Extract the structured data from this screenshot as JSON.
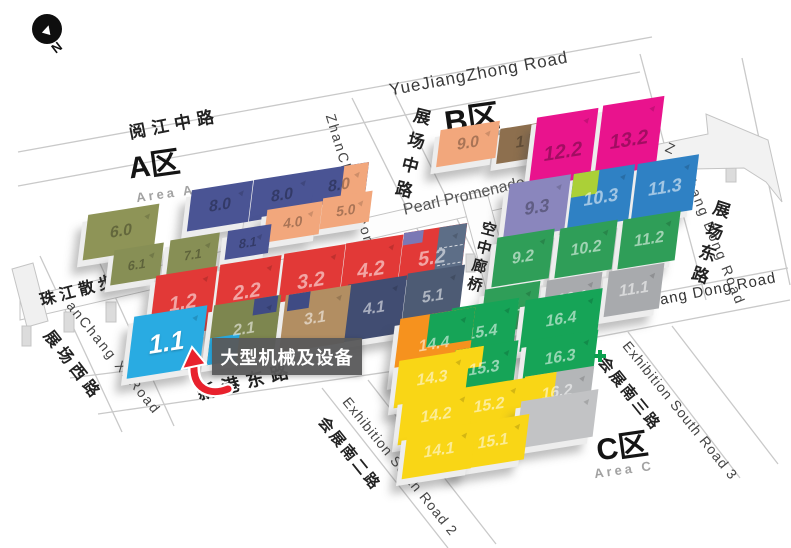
{
  "compass": {
    "label": "N"
  },
  "areas": {
    "a": {
      "title": "A区",
      "subtitle": "Area A"
    },
    "b": {
      "title": "B区",
      "subtitle": "Area B"
    },
    "c": {
      "title": "C区",
      "subtitle": "Area C"
    }
  },
  "roads": {
    "yuejiang": {
      "cn": "阅江中路",
      "en": "YueJiangZhong Road"
    },
    "zhanchang_zhong": {
      "cn": "展场中路",
      "en": "ZhanChang Zhon"
    },
    "zhanchang_dong": {
      "cn": "展场东路",
      "en_prefix": "Z",
      "en": "Chang Dong Road"
    },
    "zhanchang_xi": {
      "cn": "展场西路",
      "en": "anChang Xi Road"
    },
    "xingang": {
      "cn": "新港东路",
      "en": "XinGang Dong Road"
    },
    "exh_south_2": {
      "cn": "会展南二路",
      "en": "Exhibition South Road 2"
    },
    "exh_south_3": {
      "cn": "会展南三路",
      "en": "Exhibition South Road 3"
    },
    "promenade": {
      "cn": "珠江散步道",
      "en": "Pearl Promenade"
    },
    "skybridge": {
      "cn": "空中廊桥",
      "en": "SKY-Bridge"
    }
  },
  "callout": {
    "text": "大型机械及设备",
    "target_hall": "1.1"
  },
  "colors": {
    "highlight_hall": "#29abe2",
    "callout_bg": "#58585a",
    "arrow_red": "#e8212d",
    "navy": "#4a5494",
    "red": "#e23937",
    "salmon": "#f2a77c",
    "olive": "#878f55",
    "magenta": "#e9138d",
    "blue": "#2f81c4",
    "green_b": "#2f9e58",
    "green_c": "#16a457",
    "yellow": "#f9d616",
    "orange": "#f6921e",
    "gray": "#a8aaad"
  },
  "halls": [
    {
      "id": "hA60",
      "name": "hall-6-0",
      "area": "A",
      "label": "6.0",
      "color": "#8e9457",
      "labelStyle": "dark"
    },
    {
      "id": "hA80c",
      "name": "hall-8-0-east",
      "area": "A",
      "label": "8.0",
      "color": "#4a5494",
      "labelStyle": "dark",
      "patches": [
        {
          "cls": "p-right",
          "color": "#f2a77c"
        }
      ]
    },
    {
      "id": "hA80b",
      "name": "hall-8-0-mid",
      "area": "A",
      "label": "8.0",
      "color": "#4a5494",
      "labelStyle": "dark"
    },
    {
      "id": "hA80a",
      "name": "hall-8-0-west",
      "area": "A",
      "label": "8.0",
      "color": "#4a5494",
      "labelStyle": "dark"
    },
    {
      "id": "hA50",
      "name": "hall-5-0",
      "area": "A",
      "label": "5.0",
      "color": "#f2a77c",
      "labelStyle": "dark"
    },
    {
      "id": "hA40",
      "name": "hall-4-0",
      "area": "A",
      "label": "4.0",
      "color": "#f2a77c",
      "labelStyle": "dark"
    },
    {
      "id": "hA81",
      "name": "hall-8-1",
      "area": "A",
      "label": "8.1",
      "color": "#4a5494",
      "labelStyle": "dark"
    },
    {
      "id": "hA71",
      "name": "hall-7-1",
      "area": "A",
      "label": "7.1",
      "color": "#878f55",
      "labelStyle": "dark"
    },
    {
      "id": "hA61",
      "name": "hall-6-1",
      "area": "A",
      "label": "6.1",
      "color": "#878f55",
      "labelStyle": "dark"
    },
    {
      "id": "hA52",
      "name": "hall-5-2",
      "area": "A",
      "label": "5.2",
      "color": "#e23937",
      "labelStyle": "light",
      "patches": [
        {
          "cls": "p-right-slate",
          "color": "#5d6e87"
        },
        {
          "cls": "p-corner-tl",
          "color": "#7b78b5"
        }
      ]
    },
    {
      "id": "hA42",
      "name": "hall-4-2",
      "area": "A",
      "label": "4.2",
      "color": "#e23937",
      "labelStyle": "light"
    },
    {
      "id": "hA32",
      "name": "hall-3-2",
      "area": "A",
      "label": "3.2",
      "color": "#e23937",
      "labelStyle": "light"
    },
    {
      "id": "hA22",
      "name": "hall-2-2",
      "area": "A",
      "label": "2.2",
      "color": "#e23937",
      "labelStyle": "light"
    },
    {
      "id": "hA12",
      "name": "hall-1-2",
      "area": "A",
      "label": "1.2",
      "color": "#e23937",
      "labelStyle": "light"
    },
    {
      "id": "hA51",
      "name": "hall-5-1",
      "area": "A",
      "label": "5.1",
      "color": "#4d5b74",
      "labelStyle": "light"
    },
    {
      "id": "hA41",
      "name": "hall-4-1",
      "area": "A",
      "label": "4.1",
      "color": "#414d72",
      "labelStyle": "light"
    },
    {
      "id": "hA31",
      "name": "hall-3-1",
      "area": "A",
      "label": "3.1",
      "color": "#b28e62",
      "labelStyle": "light",
      "patches": [
        {
          "cls": "p-tl-navy",
          "color": "#3f4b84"
        }
      ]
    },
    {
      "id": "hA21",
      "name": "hall-2-1",
      "area": "A",
      "label": "2.1",
      "color": "#7d864f",
      "labelStyle": "light",
      "patches": [
        {
          "cls": "p-bl-cyan",
          "color": "#29abe2"
        },
        {
          "cls": "p-tr-navy",
          "color": "#3f4b84"
        }
      ]
    },
    {
      "id": "hA11",
      "name": "hall-1-1-highlighted",
      "area": "A",
      "label": "1.1",
      "color": "#29abe2",
      "labelStyle": "white"
    },
    {
      "id": "hB1x",
      "name": "hall-b-brown-1",
      "area": "B",
      "label": "1",
      "color": "#8d6f4e",
      "labelStyle": "dark"
    },
    {
      "id": "hB132",
      "name": "hall-13-2",
      "area": "B",
      "label": "13.2",
      "color": "#e9138d",
      "labelStyle": "dark"
    },
    {
      "id": "hB122",
      "name": "hall-12-2",
      "area": "B",
      "label": "12.2",
      "color": "#e9138d",
      "labelStyle": "dark"
    },
    {
      "id": "hB90",
      "name": "hall-9-0",
      "area": "B",
      "label": "9.0",
      "color": "#f2a77c",
      "labelStyle": "dark"
    },
    {
      "id": "hB113",
      "name": "hall-11-3",
      "area": "B",
      "label": "11.3",
      "color": "#2f81c4",
      "labelStyle": "light"
    },
    {
      "id": "hB103",
      "name": "hall-10-3",
      "area": "B",
      "label": "10.3",
      "color": "#2f81c4",
      "labelStyle": "light",
      "patches": [
        {
          "cls": "p-tl-lime",
          "color": "#abd037"
        }
      ]
    },
    {
      "id": "hB93",
      "name": "hall-9-3",
      "area": "B",
      "label": "9.3",
      "color": "#8a86bd",
      "labelStyle": "dark"
    },
    {
      "id": "hB112",
      "name": "hall-11-2",
      "area": "B",
      "label": "11.2",
      "color": "#2f9e58",
      "labelStyle": "light"
    },
    {
      "id": "hB102",
      "name": "hall-10-2",
      "area": "B",
      "label": "10.2",
      "color": "#2f9e58",
      "labelStyle": "light"
    },
    {
      "id": "hB92",
      "name": "hall-9-2",
      "area": "B",
      "label": "9.2",
      "color": "#2f9e58",
      "labelStyle": "light"
    },
    {
      "id": "hB111",
      "name": "hall-11-1",
      "area": "B",
      "label": "11.1",
      "color": "#a8aaad",
      "labelStyle": "light"
    },
    {
      "id": "hB101",
      "name": "hall-10-1",
      "area": "B",
      "label": "10.1",
      "color": "#a8aaad",
      "labelStyle": "light"
    },
    {
      "id": "hB91",
      "name": "hall-9-1",
      "area": "B",
      "label": "9.1",
      "color": "#2f9e58",
      "labelStyle": "light"
    },
    {
      "id": "hC164",
      "name": "hall-16-4",
      "area": "C",
      "label": "16.4",
      "color": "#16a457",
      "labelStyle": "light"
    },
    {
      "id": "hC154",
      "name": "hall-15-4",
      "area": "C",
      "label": "15.4",
      "color": "#16a457",
      "labelStyle": "light"
    },
    {
      "id": "hC144",
      "name": "hall-14-4",
      "area": "C",
      "label": "14.4",
      "color": "#f6921e",
      "labelStyle": "light",
      "patches": [
        {
          "cls": "p-tr-green",
          "color": "#16a457"
        }
      ]
    },
    {
      "id": "hC163",
      "name": "hall-16-3",
      "area": "C",
      "label": "16.3",
      "color": "#16a457",
      "labelStyle": "light"
    },
    {
      "id": "hC153",
      "name": "hall-15-3",
      "area": "C",
      "label": "15.3",
      "color": "#16a457",
      "labelStyle": "light",
      "patches": [
        {
          "cls": "p-tl-yellow",
          "color": "#f9d616"
        }
      ]
    },
    {
      "id": "hC143",
      "name": "hall-14-3",
      "area": "C",
      "label": "14.3",
      "color": "#f9d616",
      "labelStyle": "light"
    },
    {
      "id": "hC162",
      "name": "hall-16-2",
      "area": "C",
      "label": "16.2",
      "color": "#b4b6b8",
      "labelStyle": "light",
      "patches": [
        {
          "cls": "p-left-yellow",
          "color": "#f9d616"
        }
      ]
    },
    {
      "id": "hC152",
      "name": "hall-15-2",
      "area": "C",
      "label": "15.2",
      "color": "#f9d616",
      "labelStyle": "light"
    },
    {
      "id": "hC142",
      "name": "hall-14-2",
      "area": "C",
      "label": "14.2",
      "color": "#f9d616",
      "labelStyle": "light"
    },
    {
      "id": "hC161",
      "name": "hall-16-1",
      "area": "C",
      "label": "",
      "color": "#c2c3c5",
      "labelStyle": "light"
    },
    {
      "id": "hC151",
      "name": "hall-15-1",
      "area": "C",
      "label": "15.1",
      "color": "#f9d616",
      "labelStyle": "light"
    },
    {
      "id": "hC141",
      "name": "hall-14-1",
      "area": "C",
      "label": "14.1",
      "color": "#f9d616",
      "labelStyle": "light"
    }
  ]
}
